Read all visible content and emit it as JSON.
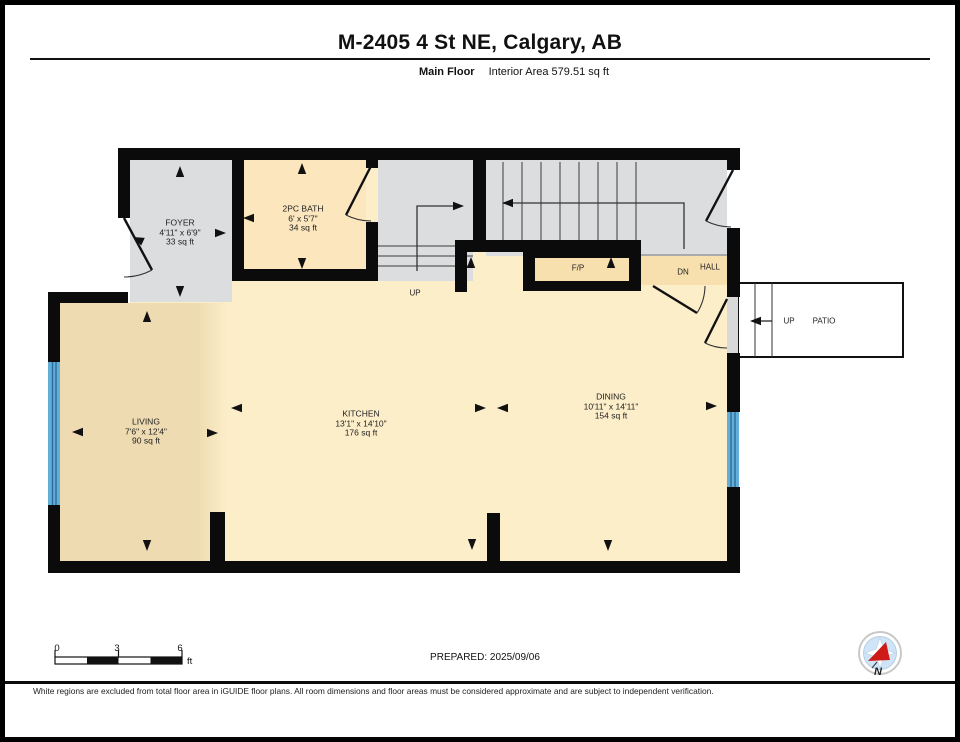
{
  "header": {
    "title": "M-2405 4 St NE, Calgary, AB",
    "floor_label": "Main Floor",
    "area_label": "Interior Area 579.51 sq ft"
  },
  "rooms": {
    "foyer": {
      "name": "FOYER",
      "dims": "4'11\" x 6'9\"",
      "area": "33 sq ft"
    },
    "bath": {
      "name": "2PC BATH",
      "dims": "6' x 5'7\"",
      "area": "34 sq ft"
    },
    "living": {
      "name": "LIVING",
      "dims": "7'6\" x 12'4\"",
      "area": "90 sq ft"
    },
    "kitchen": {
      "name": "KITCHEN",
      "dims": "13'1\" x 14'10\"",
      "area": "176 sq ft"
    },
    "dining": {
      "name": "DINING",
      "dims": "10'11\" x 14'11\"",
      "area": "154 sq ft"
    }
  },
  "plan_labels": {
    "fireplace": "F/P",
    "down": "DN",
    "hall": "HALL",
    "stairs_up": "UP",
    "patio_up": "UP",
    "patio": "PATIO"
  },
  "scale_bar": {
    "tick0": "0",
    "tick3": "3",
    "tick6": "6",
    "unit": "ft"
  },
  "prepared_label": "PREPARED: 2025/09/06",
  "compass": {
    "north": "N"
  },
  "footer": {
    "disclaimer": "White regions are excluded from total floor area in iGUIDE floor plans. All room dimensions and floor areas must be considered approximate and are subject to independent verification."
  },
  "colors": {
    "wall": "#0b0b0b",
    "room_gray": "#dcdddf",
    "cream": "#fdeeca",
    "living_tan": "#eedbb2",
    "bath_fill": "#fce6bd",
    "beige": "#f8dfae",
    "window_blue": "#62aed9",
    "compass_red": "#cf1a1a"
  }
}
